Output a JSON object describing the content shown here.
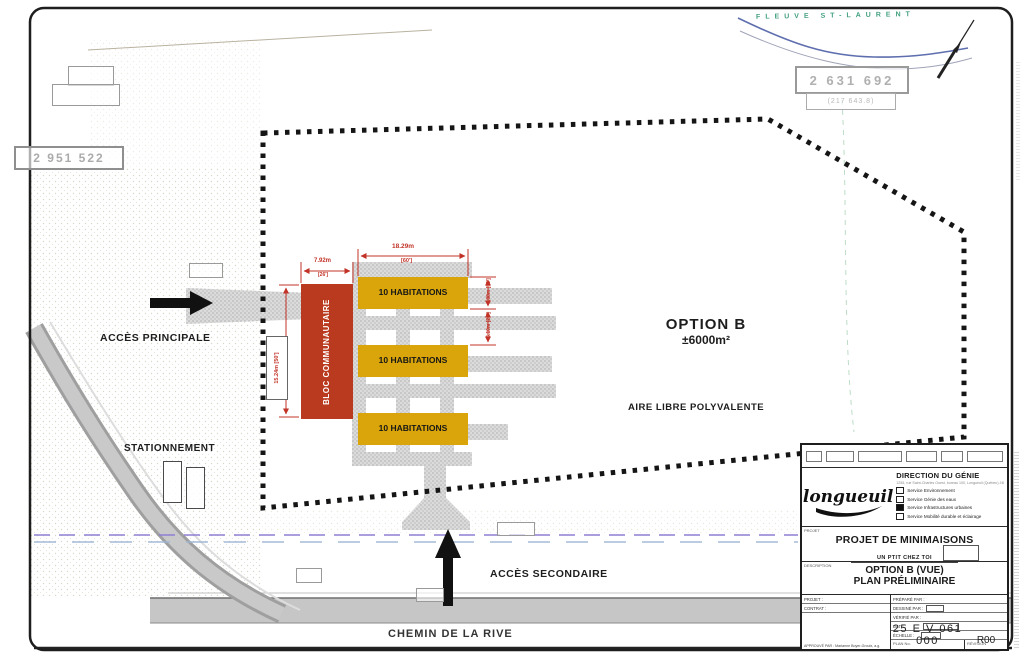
{
  "colors": {
    "habitation_block": "#D9A50B",
    "community_block": "#B93A1E",
    "dimension_red": "#C23327",
    "river_blue": "#5E6EAE",
    "river_text_green": "#43A07E",
    "boundary_black": "#151515"
  },
  "map": {
    "river_label": "FLEUVE ST-LAURENT",
    "road_label": "CHEMIN DE LA RIVE",
    "access_principal": "ACCÈS PRINCIPALE",
    "access_secondary": "ACCÈS SECONDAIRE",
    "parking": "STATIONNEMENT",
    "option_title": "OPTION B",
    "option_area": "±6000m²",
    "open_area": "AIRE LIBRE POLYVALENTE",
    "bloc_label": "BLOC COMMUNAUTAIRE",
    "buildings": [
      {
        "label": "10 HABITATIONS"
      },
      {
        "label": "10 HABITATIONS"
      },
      {
        "label": "10 HABITATIONS"
      }
    ],
    "lots": {
      "west": "2 951 522",
      "northeast": "2 631 692",
      "northeast_area": "(217 643.8)"
    },
    "dimensions": {
      "row_width": "18.29m",
      "row_width_ft": "[60']",
      "bloc_width": "7.92m",
      "bloc_width_ft": "[26']",
      "bloc_height": "15.24m [50']",
      "hab_depth": "4.88m [16']",
      "hab_gap": "6.10m [20']"
    }
  },
  "title_block": {
    "logo_text": "longueuil",
    "department": "DIRECTION DU GÉNIE",
    "address": "1255, rue Saint-Charles Ouest, bureau 100, Longueuil (Québec) J4K 1A1",
    "services": [
      {
        "label": "Service Environnement",
        "checked": false
      },
      {
        "label": "Service Génie des eaux",
        "checked": false
      },
      {
        "label": "Service Infrastructures urbaines",
        "checked": true
      },
      {
        "label": "Service Mobilité durable et éclairage",
        "checked": false
      }
    ],
    "projet_section_label": "PROJET",
    "project_title": "PROJET DE MINIMAISONS",
    "project_subtitle": "UN PTIT CHEZ TOI",
    "description_section_label": "DESCRIPTION",
    "description_line1": "OPTION B (VUE)",
    "description_line2": "PLAN PRÉLIMINAIRE",
    "projet_field": "PROJET :",
    "contrat_field": "CONTRAT :",
    "prepared_by": "PRÉPARÉ PAR :",
    "drawn_by": "DESSINÉ PAR :",
    "checked_by": "VÉRIFIÉ PAR :",
    "date_label": "DATE :",
    "scale_label": "ÉCHELLE :",
    "plan_no_label": "PLAN No.",
    "plan_no": "25 E V 061 000",
    "revision_label": "RÉVISION",
    "revision": "R00",
    "approved_by": "APPROUVÉ PAR : Marianne Boyer-Groulx, a.g."
  }
}
